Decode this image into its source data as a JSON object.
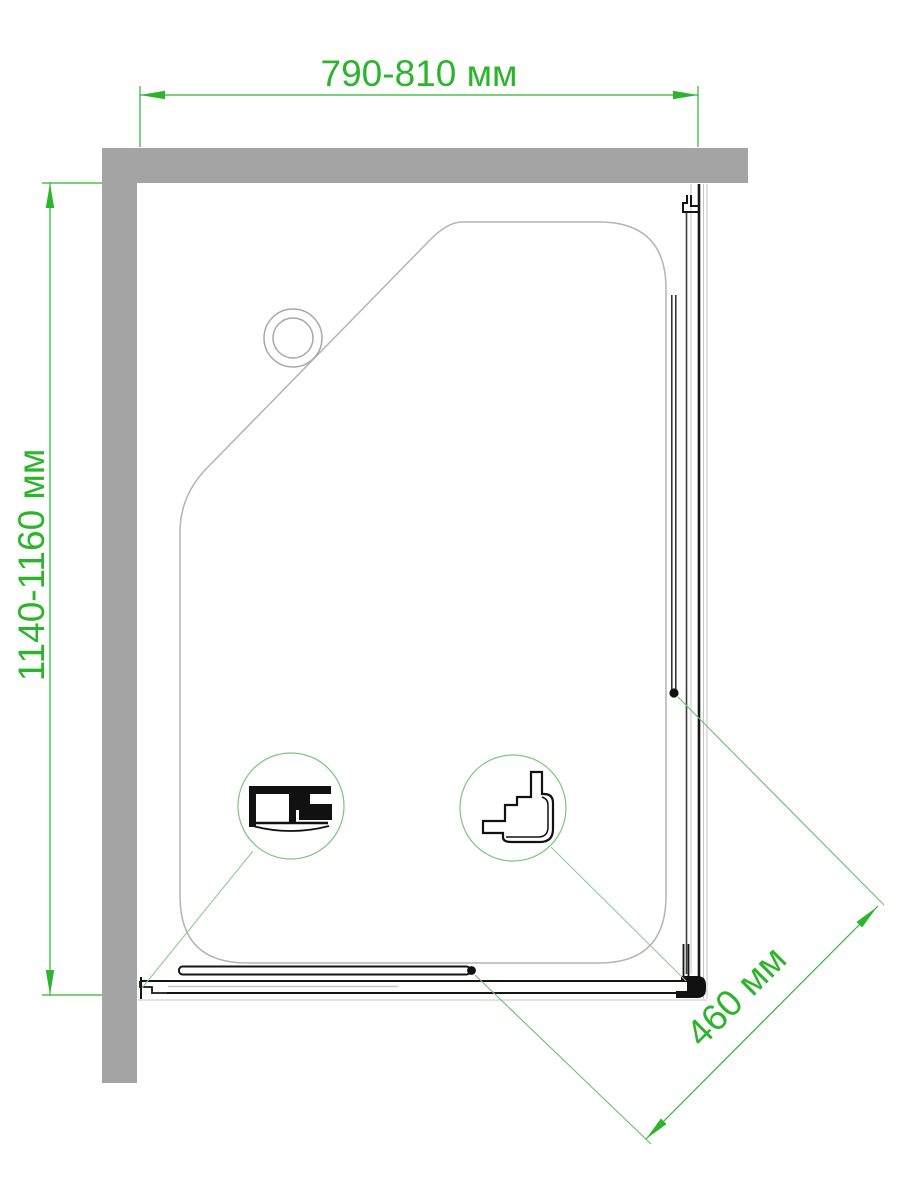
{
  "drawing": {
    "kind": "shower-enclosure-plan-view"
  },
  "dimensions": {
    "width": {
      "label": "790-810 мм"
    },
    "height": {
      "label": "1140-1160 мм"
    },
    "door": {
      "label": "460 мм"
    }
  },
  "colors": {
    "dimension_green": "#2cb52c",
    "leader_green": "#8ecd8e",
    "detail_circle_green": "#7cc67c",
    "wall_gray": "#a4a4a4",
    "tray_gray": "#b4b4b4",
    "profile_black": "#151515",
    "glass_dark": "#3a3a3a",
    "light_gray": "#c4c4c4"
  }
}
